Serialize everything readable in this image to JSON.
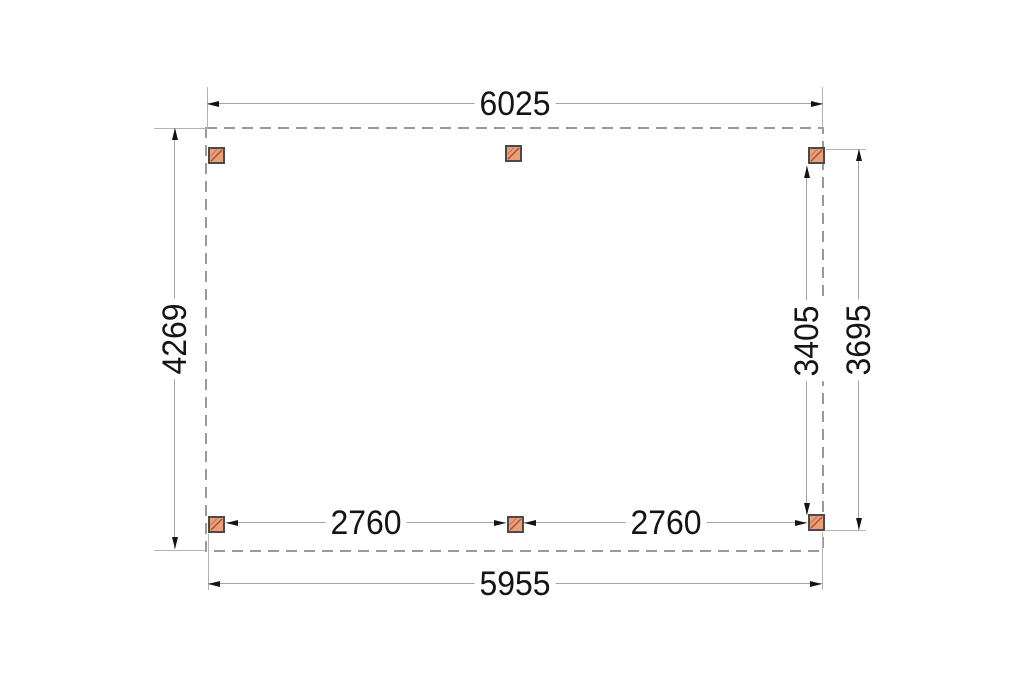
{
  "drawing": {
    "kind": "plan-view technical drawing of a rectangular canopy with six posts",
    "labels": {
      "top_width": "6025",
      "left_height": "4269",
      "right_post_span": "3405",
      "right_overall_height": "3695",
      "bottom_span_left": "2760",
      "bottom_span_right": "2760",
      "bottom_width": "5955"
    },
    "posts": [
      {
        "name": "post-top-left"
      },
      {
        "name": "post-top-center"
      },
      {
        "name": "post-top-right"
      },
      {
        "name": "post-bottom-left"
      },
      {
        "name": "post-bottom-center"
      },
      {
        "name": "post-bottom-right"
      }
    ],
    "colors": {
      "background": "#ffffff",
      "dashed_outline": "#999999",
      "dimension_line": "#a3a3a3",
      "extension_line": "#b3b3b3",
      "arrow_and_text": "#141414",
      "post_fill": "#eb9e7a",
      "post_border": "#4a4a4a",
      "post_grain": "#a5512b"
    }
  }
}
